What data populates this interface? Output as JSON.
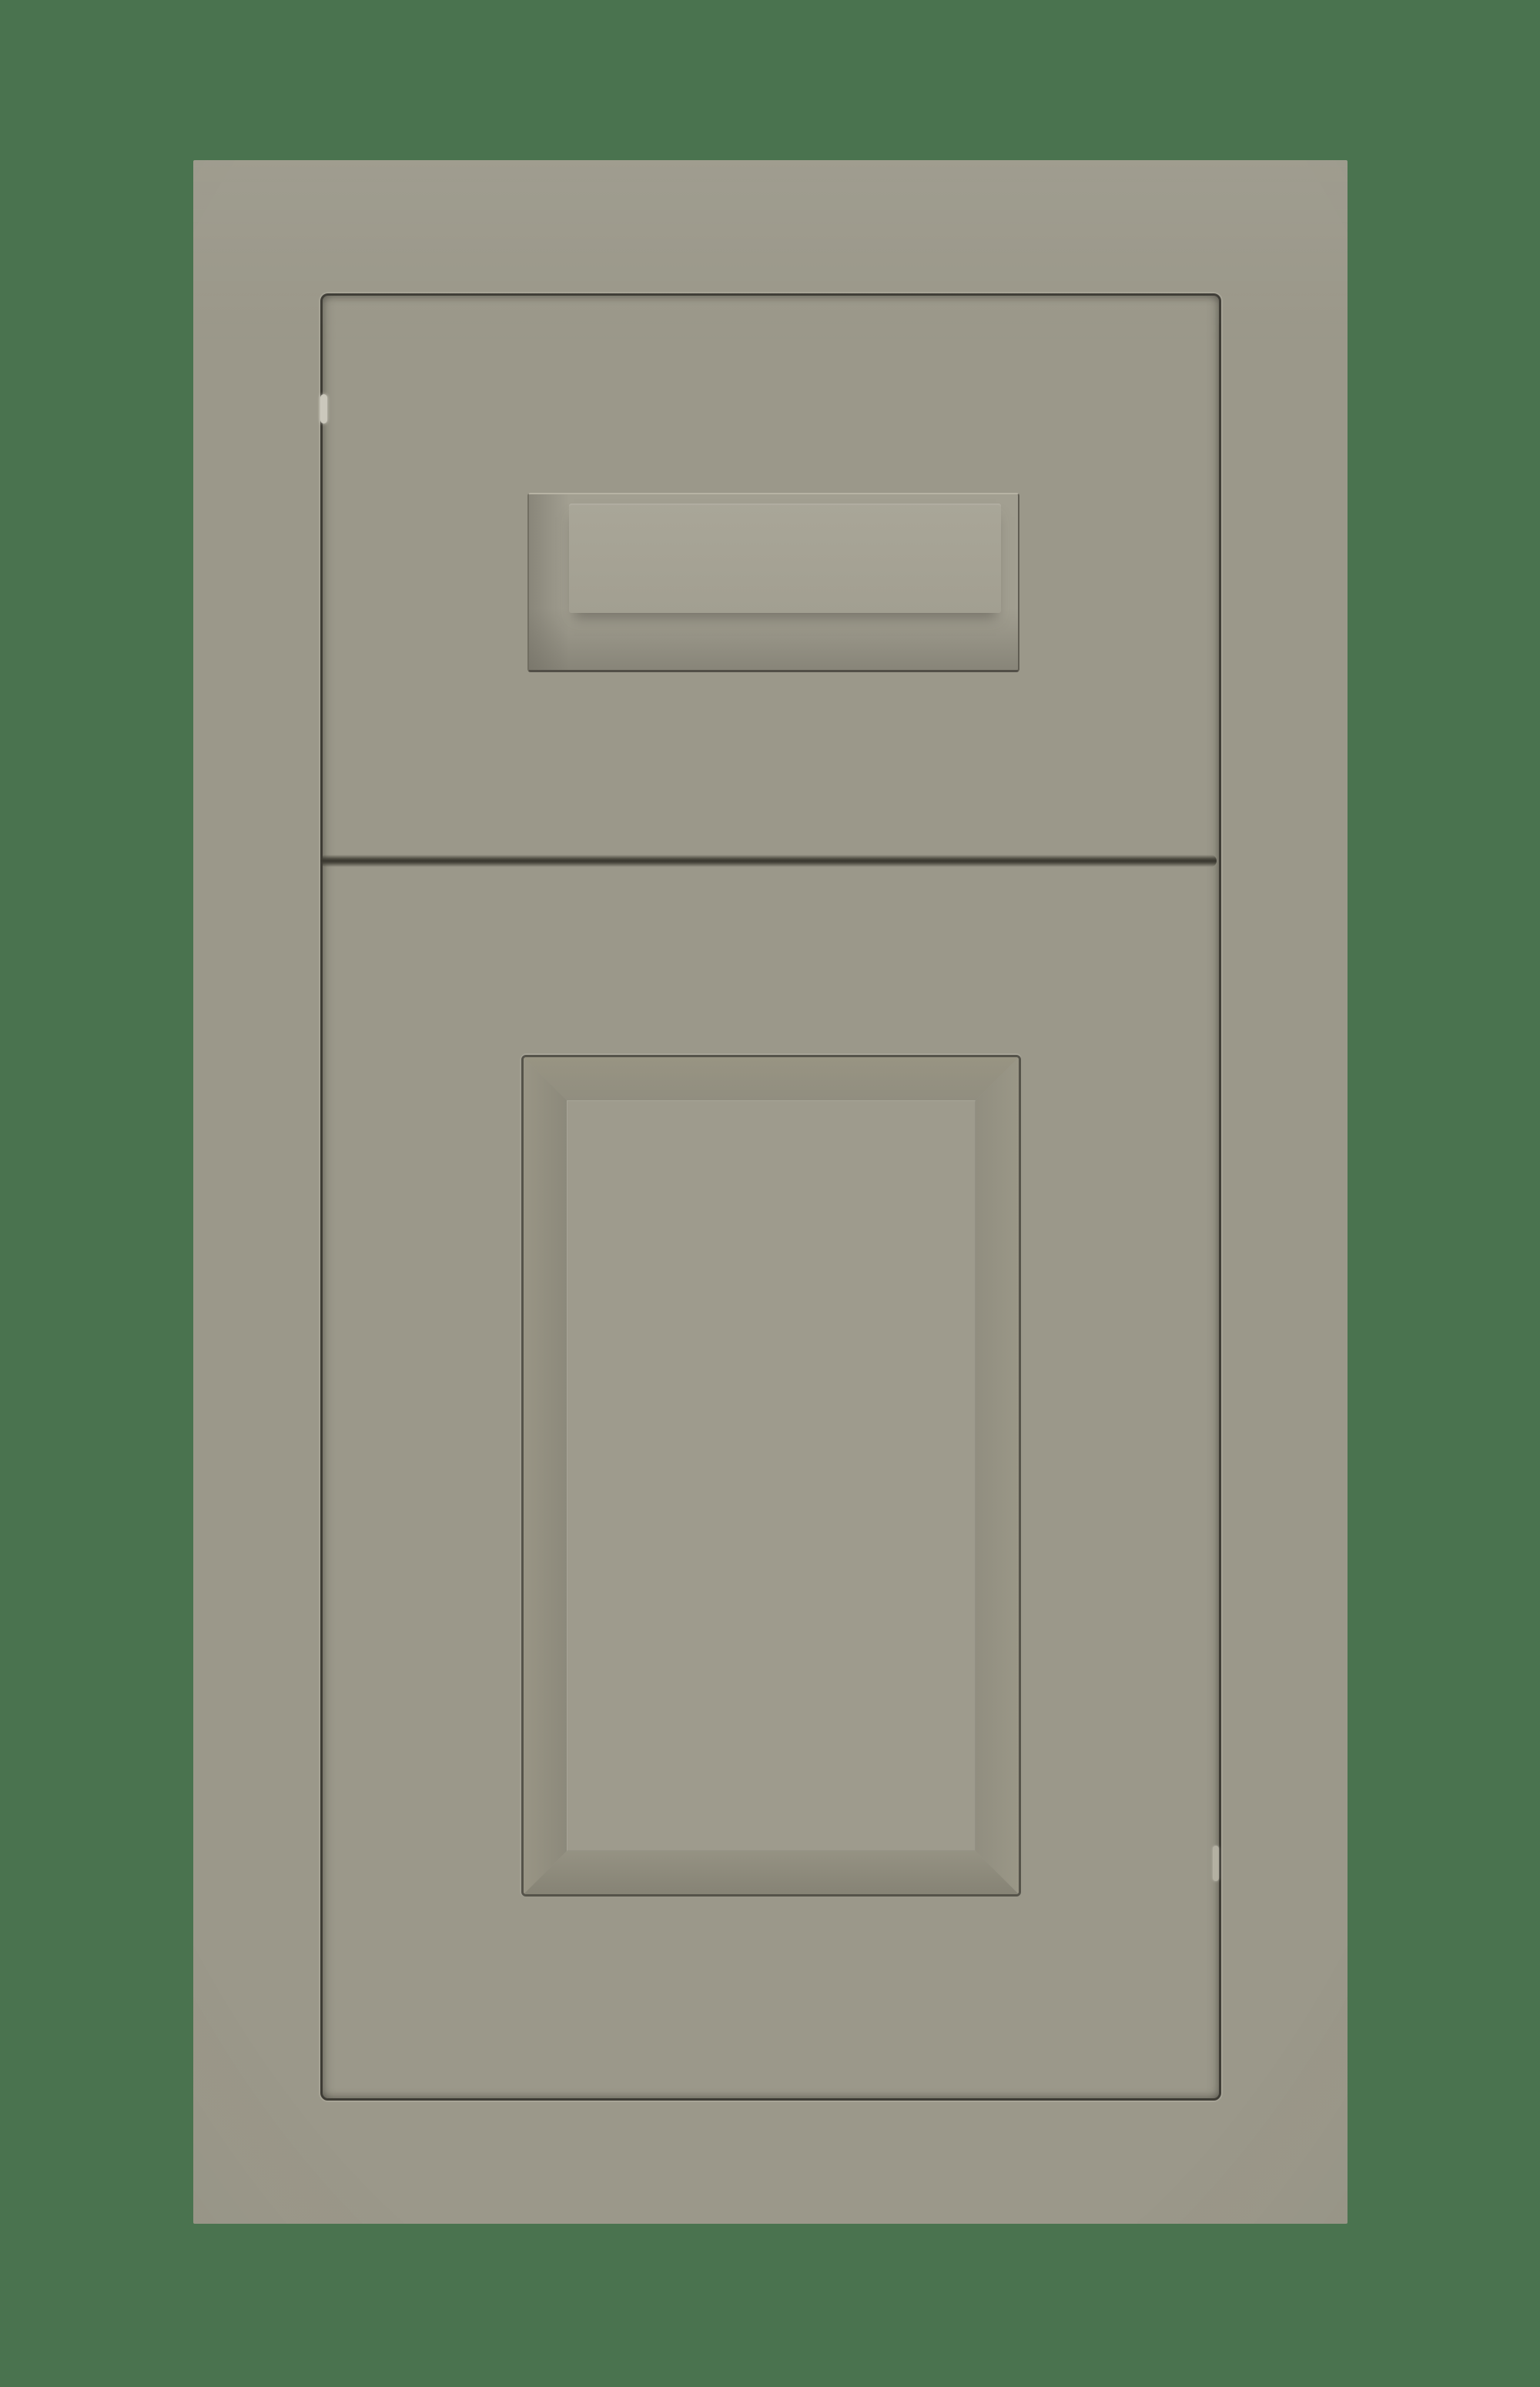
{
  "scene": {
    "description": "Product photo of a painted gray (greige) kitchen cabinet sample on a solid green background: a face frame holding a top drawer front with an integrated recessed finger pull and, below it, a five-piece door with a raised center panel.",
    "parts": {
      "background": "green backdrop",
      "sample": "gray cabinet sample",
      "face_frame": "face frame",
      "drawer_front": "drawer front",
      "drawer_pull_recess": "recessed pull pocket",
      "drawer_pull": "raised integrated pull",
      "gap": "reveal gap between drawer front and door",
      "door": "cabinet door",
      "door_panel": "door panel groove and bevel",
      "center_panel": "raised center panel",
      "hinge_mark_left": "light reflection on left seam",
      "hinge_mark_right": "light reflection on right seam"
    }
  },
  "colors": {
    "bg": "#4a734f",
    "finish": "#9b988a",
    "finish-light": "#a29f91",
    "finish-lighter": "#a9a698",
    "field": "#9e9b8d",
    "seam": "#3e3c35",
    "gap-core": "#39372f",
    "groove": "#55534a",
    "bevel-dark": "#868375",
    "hairline-light": "#c8c5b9",
    "hinge-left": "#cbc8bc",
    "hinge-right": "#b8b5a7"
  }
}
